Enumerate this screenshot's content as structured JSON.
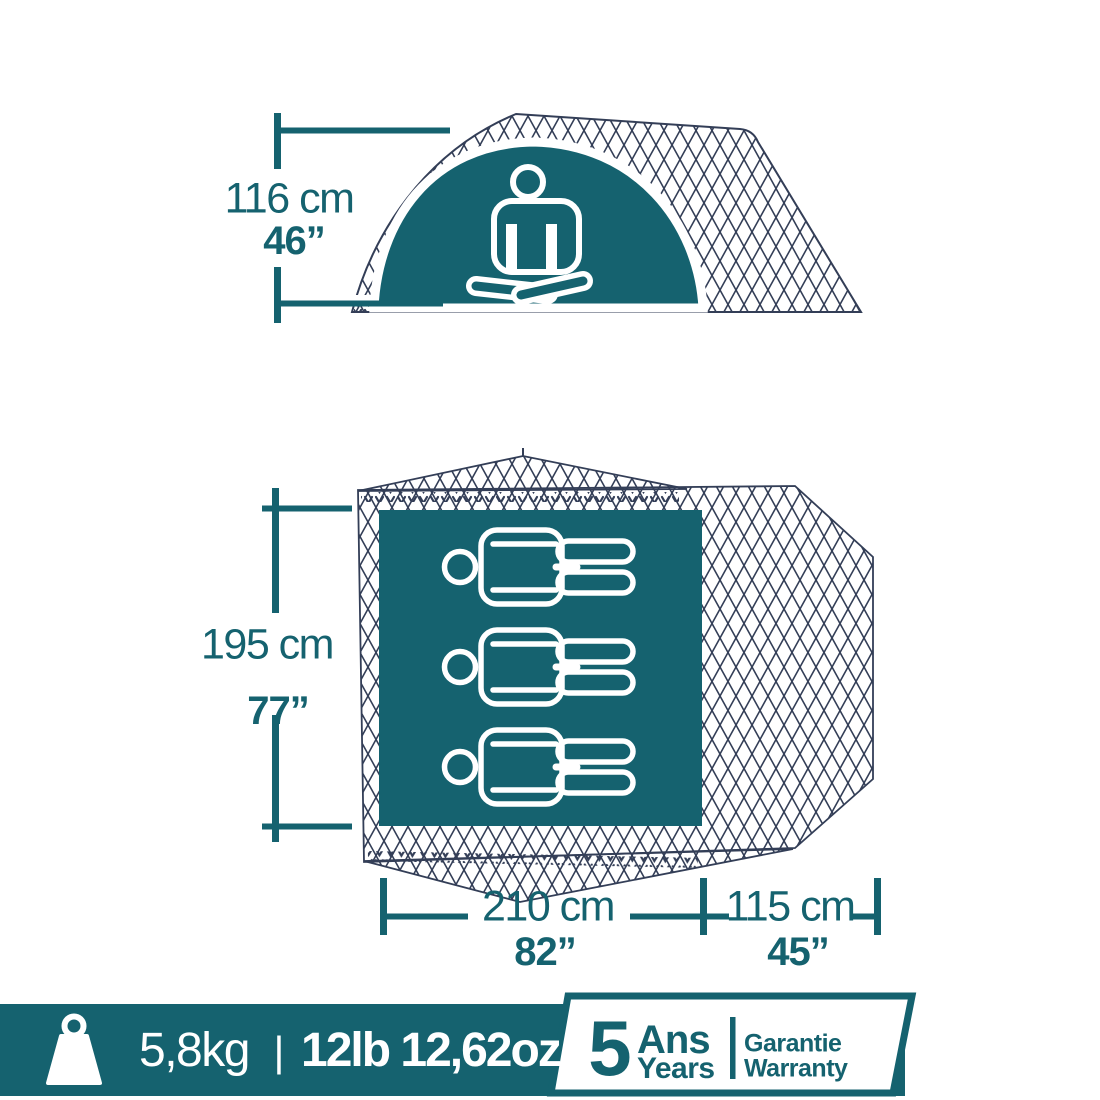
{
  "colors": {
    "teal": "#15626F",
    "navy": "#333E57",
    "background": "#FFFFFF",
    "icon_white": "#FFFFFF"
  },
  "side_view": {
    "description": "tent side elevation with mesh fabric, teal door dome and meditating person",
    "person_icon": "meditating-person-icon",
    "height_cm": "116 cm",
    "height_in": "46”"
  },
  "floor_plan": {
    "description": "tent top view: mesh groundsheet, teal bedroom with 3 sleepers, side vestibule",
    "person_icon": "lying-person-icon",
    "capacity": 3,
    "depth_cm": "195 cm",
    "depth_in": "77”",
    "width_cm": "210 cm",
    "width_in": "82”",
    "vestibule_cm": "115 cm",
    "vestibule_in": "45”"
  },
  "footer": {
    "weight_icon": "weight-icon",
    "weight_metric": "5,8kg",
    "separator": "|",
    "weight_imperial": "12lb 12,62oz",
    "warranty": {
      "years_number": "5",
      "years_label_fr": "Ans",
      "years_label_en": "Years",
      "warranty_label_fr": "Garantie",
      "warranty_label_en": "Warranty"
    }
  }
}
